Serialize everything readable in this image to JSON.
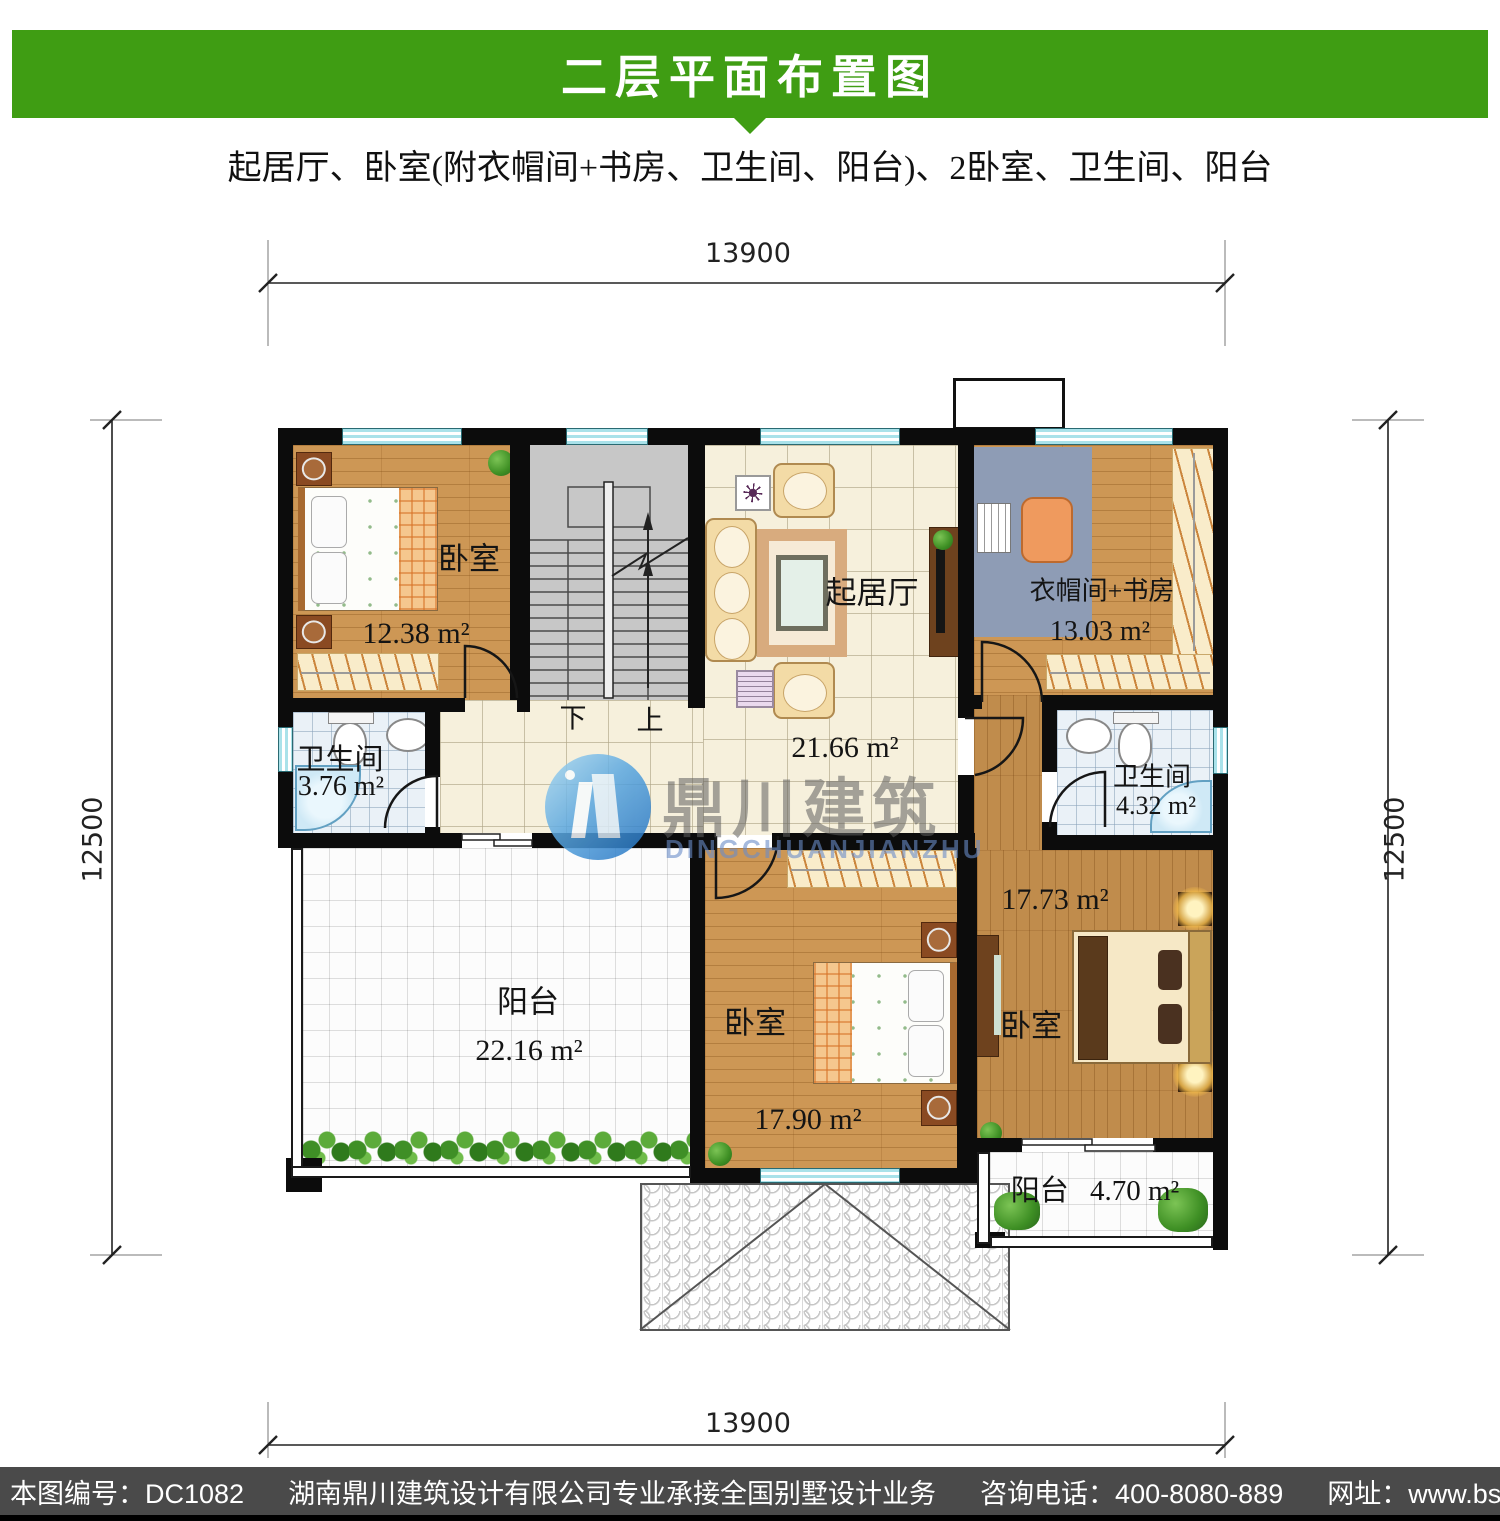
{
  "header": {
    "title": "二层平面布置图",
    "subtitle": "起居厅、卧室(附衣帽间+书房、卫生间、阳台)、2卧室、卫生间、阳台"
  },
  "dimensions": {
    "top": "13900",
    "bottom": "13900",
    "left": "12500",
    "right": "12500"
  },
  "rooms": {
    "bedroom_top_left": {
      "name": "卧室",
      "area": "12.38 m²"
    },
    "bath_left": {
      "name": "卫生间",
      "area": "3.76 m²"
    },
    "living": {
      "name": "起居厅",
      "area": "21.66 m²"
    },
    "study": {
      "name": "衣帽间+书房",
      "area": "13.03 m²"
    },
    "bath_right": {
      "name": "卫生间",
      "area": "4.32 m²"
    },
    "balcony_large": {
      "name": "阳台",
      "area": "22.16 m²"
    },
    "bedroom_bottom": {
      "name": "卧室",
      "area": "17.90 m²"
    },
    "bedroom_right": {
      "name": "卧室",
      "area": "17.73 m²"
    },
    "balcony_small": {
      "name": "阳台",
      "area": "4.70 m²"
    }
  },
  "stairs": {
    "down_label": "下",
    "up_label": "上"
  },
  "watermark": {
    "cn": "鼎川建筑",
    "en": "DINGCHUANJIANZHU"
  },
  "footer": {
    "plan_no": "本图编号：DC1082",
    "company": "湖南鼎川建筑设计有限公司专业承接全国别墅设计业务",
    "phone": "咨询电话：400-8080-889",
    "website": "网址：www.bstzcs.com"
  },
  "colors": {
    "accent_green": "#3f9d13",
    "footer_bg": "#4a4a4a"
  }
}
